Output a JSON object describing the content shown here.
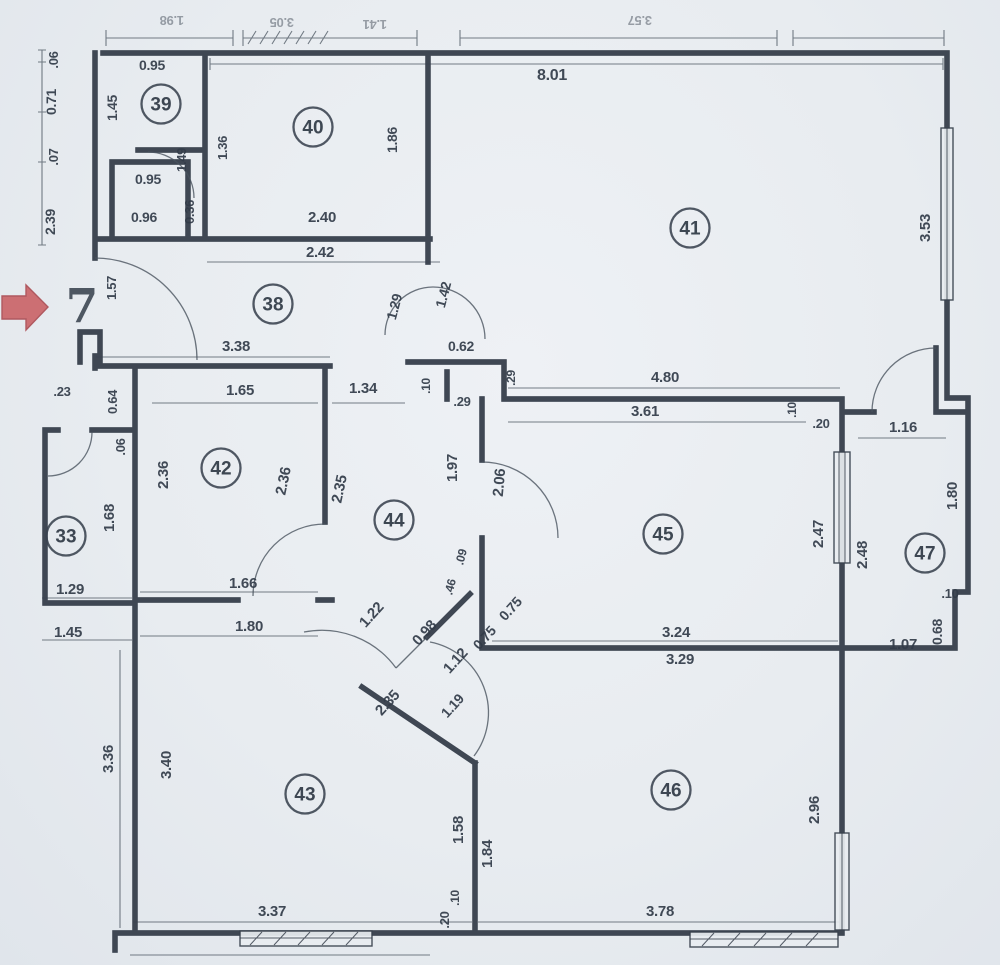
{
  "plan": {
    "title": "apartment-floor-plan-scan",
    "paper_color": "#e9edf1",
    "ink_color": "#39424e",
    "accent_red": "#c95f63",
    "entrance_number": "7",
    "rooms": [
      {
        "number": "33",
        "cx": 66,
        "cy": 536
      },
      {
        "number": "38",
        "cx": 273,
        "cy": 304
      },
      {
        "number": "39",
        "cx": 161,
        "cy": 104
      },
      {
        "number": "40",
        "cx": 313,
        "cy": 127
      },
      {
        "number": "41",
        "cx": 690,
        "cy": 228
      },
      {
        "number": "42",
        "cx": 221,
        "cy": 468
      },
      {
        "number": "43",
        "cx": 305,
        "cy": 794
      },
      {
        "number": "44",
        "cx": 394,
        "cy": 520
      },
      {
        "number": "45",
        "cx": 663,
        "cy": 534
      },
      {
        "number": "46",
        "cx": 671,
        "cy": 790
      },
      {
        "number": "47",
        "cx": 925,
        "cy": 553
      }
    ],
    "dimensions": [
      {
        "text": "1.98",
        "x": 172,
        "y": 16,
        "rot": 180,
        "size": 13,
        "faint": true
      },
      {
        "text": "3.05",
        "x": 282,
        "y": 18,
        "rot": 180,
        "size": 13,
        "faint": true
      },
      {
        "text": "1.41",
        "x": 375,
        "y": 20,
        "rot": 180,
        "size": 13,
        "faint": true
      },
      {
        "text": "3.57",
        "x": 640,
        "y": 16,
        "rot": 180,
        "size": 13,
        "faint": true
      },
      {
        "text": "8.01",
        "x": 552,
        "y": 80,
        "rot": 0,
        "size": 16
      },
      {
        "text": ".06",
        "x": 58,
        "y": 60,
        "rot": -90,
        "size": 13
      },
      {
        "text": "0.71",
        "x": 56,
        "y": 102,
        "rot": -90,
        "size": 14
      },
      {
        "text": ".07",
        "x": 58,
        "y": 157,
        "rot": -90,
        "size": 13
      },
      {
        "text": "2.39",
        "x": 55,
        "y": 222,
        "rot": -90,
        "size": 14
      },
      {
        "text": "0.95",
        "x": 152,
        "y": 70,
        "rot": 0,
        "size": 14
      },
      {
        "text": "1.45",
        "x": 117,
        "y": 108,
        "rot": -90,
        "size": 14
      },
      {
        "text": "1.49",
        "x": 186,
        "y": 160,
        "rot": -90,
        "size": 13
      },
      {
        "text": "1.36",
        "x": 227,
        "y": 148,
        "rot": -90,
        "size": 13
      },
      {
        "text": "0.95",
        "x": 148,
        "y": 184,
        "rot": 0,
        "size": 14
      },
      {
        "text": "0.96",
        "x": 144,
        "y": 222,
        "rot": 0,
        "size": 14
      },
      {
        "text": "0.36",
        "x": 194,
        "y": 212,
        "rot": -90,
        "size": 13
      },
      {
        "text": "1.86",
        "x": 397,
        "y": 140,
        "rot": -90,
        "size": 14
      },
      {
        "text": "2.40",
        "x": 322,
        "y": 222,
        "rot": 0,
        "size": 15
      },
      {
        "text": "2.42",
        "x": 320,
        "y": 257,
        "rot": 0,
        "size": 15
      },
      {
        "text": "3.53",
        "x": 930,
        "y": 228,
        "rot": -90,
        "size": 15
      },
      {
        "text": "1.57",
        "x": 116,
        "y": 288,
        "rot": -90,
        "size": 13
      },
      {
        "text": "1.29",
        "x": 399,
        "y": 308,
        "rot": -75,
        "size": 14
      },
      {
        "text": "1.42",
        "x": 448,
        "y": 296,
        "rot": -75,
        "size": 14
      },
      {
        "text": "3.38",
        "x": 236,
        "y": 351,
        "rot": 0,
        "size": 15
      },
      {
        "text": "0.62",
        "x": 461,
        "y": 351,
        "rot": 0,
        "size": 14
      },
      {
        "text": ".10",
        "x": 430,
        "y": 386,
        "rot": -90,
        "size": 12
      },
      {
        "text": ".29",
        "x": 462,
        "y": 406,
        "rot": 0,
        "size": 13
      },
      {
        "text": ".29",
        "x": 515,
        "y": 378,
        "rot": -90,
        "size": 12
      },
      {
        "text": ".23",
        "x": 62,
        "y": 396,
        "rot": 0,
        "size": 13
      },
      {
        "text": "0.64",
        "x": 117,
        "y": 402,
        "rot": -90,
        "size": 13
      },
      {
        "text": ".06",
        "x": 125,
        "y": 447,
        "rot": -90,
        "size": 13
      },
      {
        "text": "1.65",
        "x": 240,
        "y": 395,
        "rot": 0,
        "size": 15
      },
      {
        "text": "1.34",
        "x": 363,
        "y": 393,
        "rot": 0,
        "size": 15
      },
      {
        "text": "2.36",
        "x": 168,
        "y": 475,
        "rot": -90,
        "size": 15
      },
      {
        "text": "2.36",
        "x": 288,
        "y": 482,
        "rot": -78,
        "size": 15
      },
      {
        "text": "2.35",
        "x": 344,
        "y": 490,
        "rot": -78,
        "size": 15
      },
      {
        "text": "1.68",
        "x": 114,
        "y": 518,
        "rot": -90,
        "size": 15
      },
      {
        "text": "1.29",
        "x": 70,
        "y": 594,
        "rot": 0,
        "size": 15
      },
      {
        "text": "1.45",
        "x": 68,
        "y": 637,
        "rot": 0,
        "size": 15
      },
      {
        "text": "1.97",
        "x": 457,
        "y": 468,
        "rot": -90,
        "size": 15
      },
      {
        "text": "2.06",
        "x": 504,
        "y": 483,
        "rot": -85,
        "size": 15
      },
      {
        "text": "4.80",
        "x": 665,
        "y": 382,
        "rot": 0,
        "size": 15
      },
      {
        "text": "3.61",
        "x": 645,
        "y": 416,
        "rot": 0,
        "size": 15
      },
      {
        "text": ".10",
        "x": 796,
        "y": 410,
        "rot": -90,
        "size": 12
      },
      {
        "text": ".20",
        "x": 821,
        "y": 428,
        "rot": 0,
        "size": 13
      },
      {
        "text": "2.47",
        "x": 823,
        "y": 534,
        "rot": -90,
        "size": 15
      },
      {
        "text": "2.48",
        "x": 867,
        "y": 555,
        "rot": -90,
        "size": 15
      },
      {
        "text": "1.16",
        "x": 903,
        "y": 432,
        "rot": 0,
        "size": 15
      },
      {
        "text": "1.80",
        "x": 957,
        "y": 496,
        "rot": -90,
        "size": 15
      },
      {
        "text": ".10",
        "x": 950,
        "y": 598,
        "rot": 0,
        "size": 13
      },
      {
        "text": "0.68",
        "x": 942,
        "y": 632,
        "rot": -90,
        "size": 14
      },
      {
        "text": "1.07",
        "x": 903,
        "y": 649,
        "rot": 0,
        "size": 15
      },
      {
        "text": ".09",
        "x": 465,
        "y": 558,
        "rot": -75,
        "size": 12
      },
      {
        "text": ".46",
        "x": 454,
        "y": 588,
        "rot": -75,
        "size": 12
      },
      {
        "text": "0.75",
        "x": 514,
        "y": 612,
        "rot": -48,
        "size": 14
      },
      {
        "text": "0.75",
        "x": 488,
        "y": 641,
        "rot": -48,
        "size": 14
      },
      {
        "text": "1.22",
        "x": 375,
        "y": 618,
        "rot": -48,
        "size": 15
      },
      {
        "text": "0.98",
        "x": 428,
        "y": 636,
        "rot": -48,
        "size": 15
      },
      {
        "text": "1.12",
        "x": 459,
        "y": 664,
        "rot": -48,
        "size": 15
      },
      {
        "text": "1.19",
        "x": 456,
        "y": 709,
        "rot": -48,
        "size": 14
      },
      {
        "text": "2.35",
        "x": 391,
        "y": 706,
        "rot": -48,
        "size": 15
      },
      {
        "text": "3.24",
        "x": 676,
        "y": 637,
        "rot": 0,
        "size": 15
      },
      {
        "text": "3.29",
        "x": 680,
        "y": 664,
        "rot": 0,
        "size": 15
      },
      {
        "text": "1.66",
        "x": 243,
        "y": 588,
        "rot": 0,
        "size": 15
      },
      {
        "text": "1.80",
        "x": 249,
        "y": 631,
        "rot": 0,
        "size": 15
      },
      {
        "text": "3.36",
        "x": 113,
        "y": 759,
        "rot": -90,
        "size": 15
      },
      {
        "text": "3.40",
        "x": 171,
        "y": 765,
        "rot": -90,
        "size": 15
      },
      {
        "text": "1.58",
        "x": 463,
        "y": 830,
        "rot": -90,
        "size": 15
      },
      {
        "text": "1.84",
        "x": 492,
        "y": 854,
        "rot": -90,
        "size": 15
      },
      {
        "text": ".10",
        "x": 459,
        "y": 898,
        "rot": -90,
        "size": 12
      },
      {
        "text": ".20",
        "x": 449,
        "y": 920,
        "rot": -90,
        "size": 13
      },
      {
        "text": "3.37",
        "x": 272,
        "y": 916,
        "rot": 0,
        "size": 15
      },
      {
        "text": "3.78",
        "x": 660,
        "y": 916,
        "rot": 0,
        "size": 15
      },
      {
        "text": "2.96",
        "x": 819,
        "y": 810,
        "rot": -90,
        "size": 15
      }
    ]
  }
}
